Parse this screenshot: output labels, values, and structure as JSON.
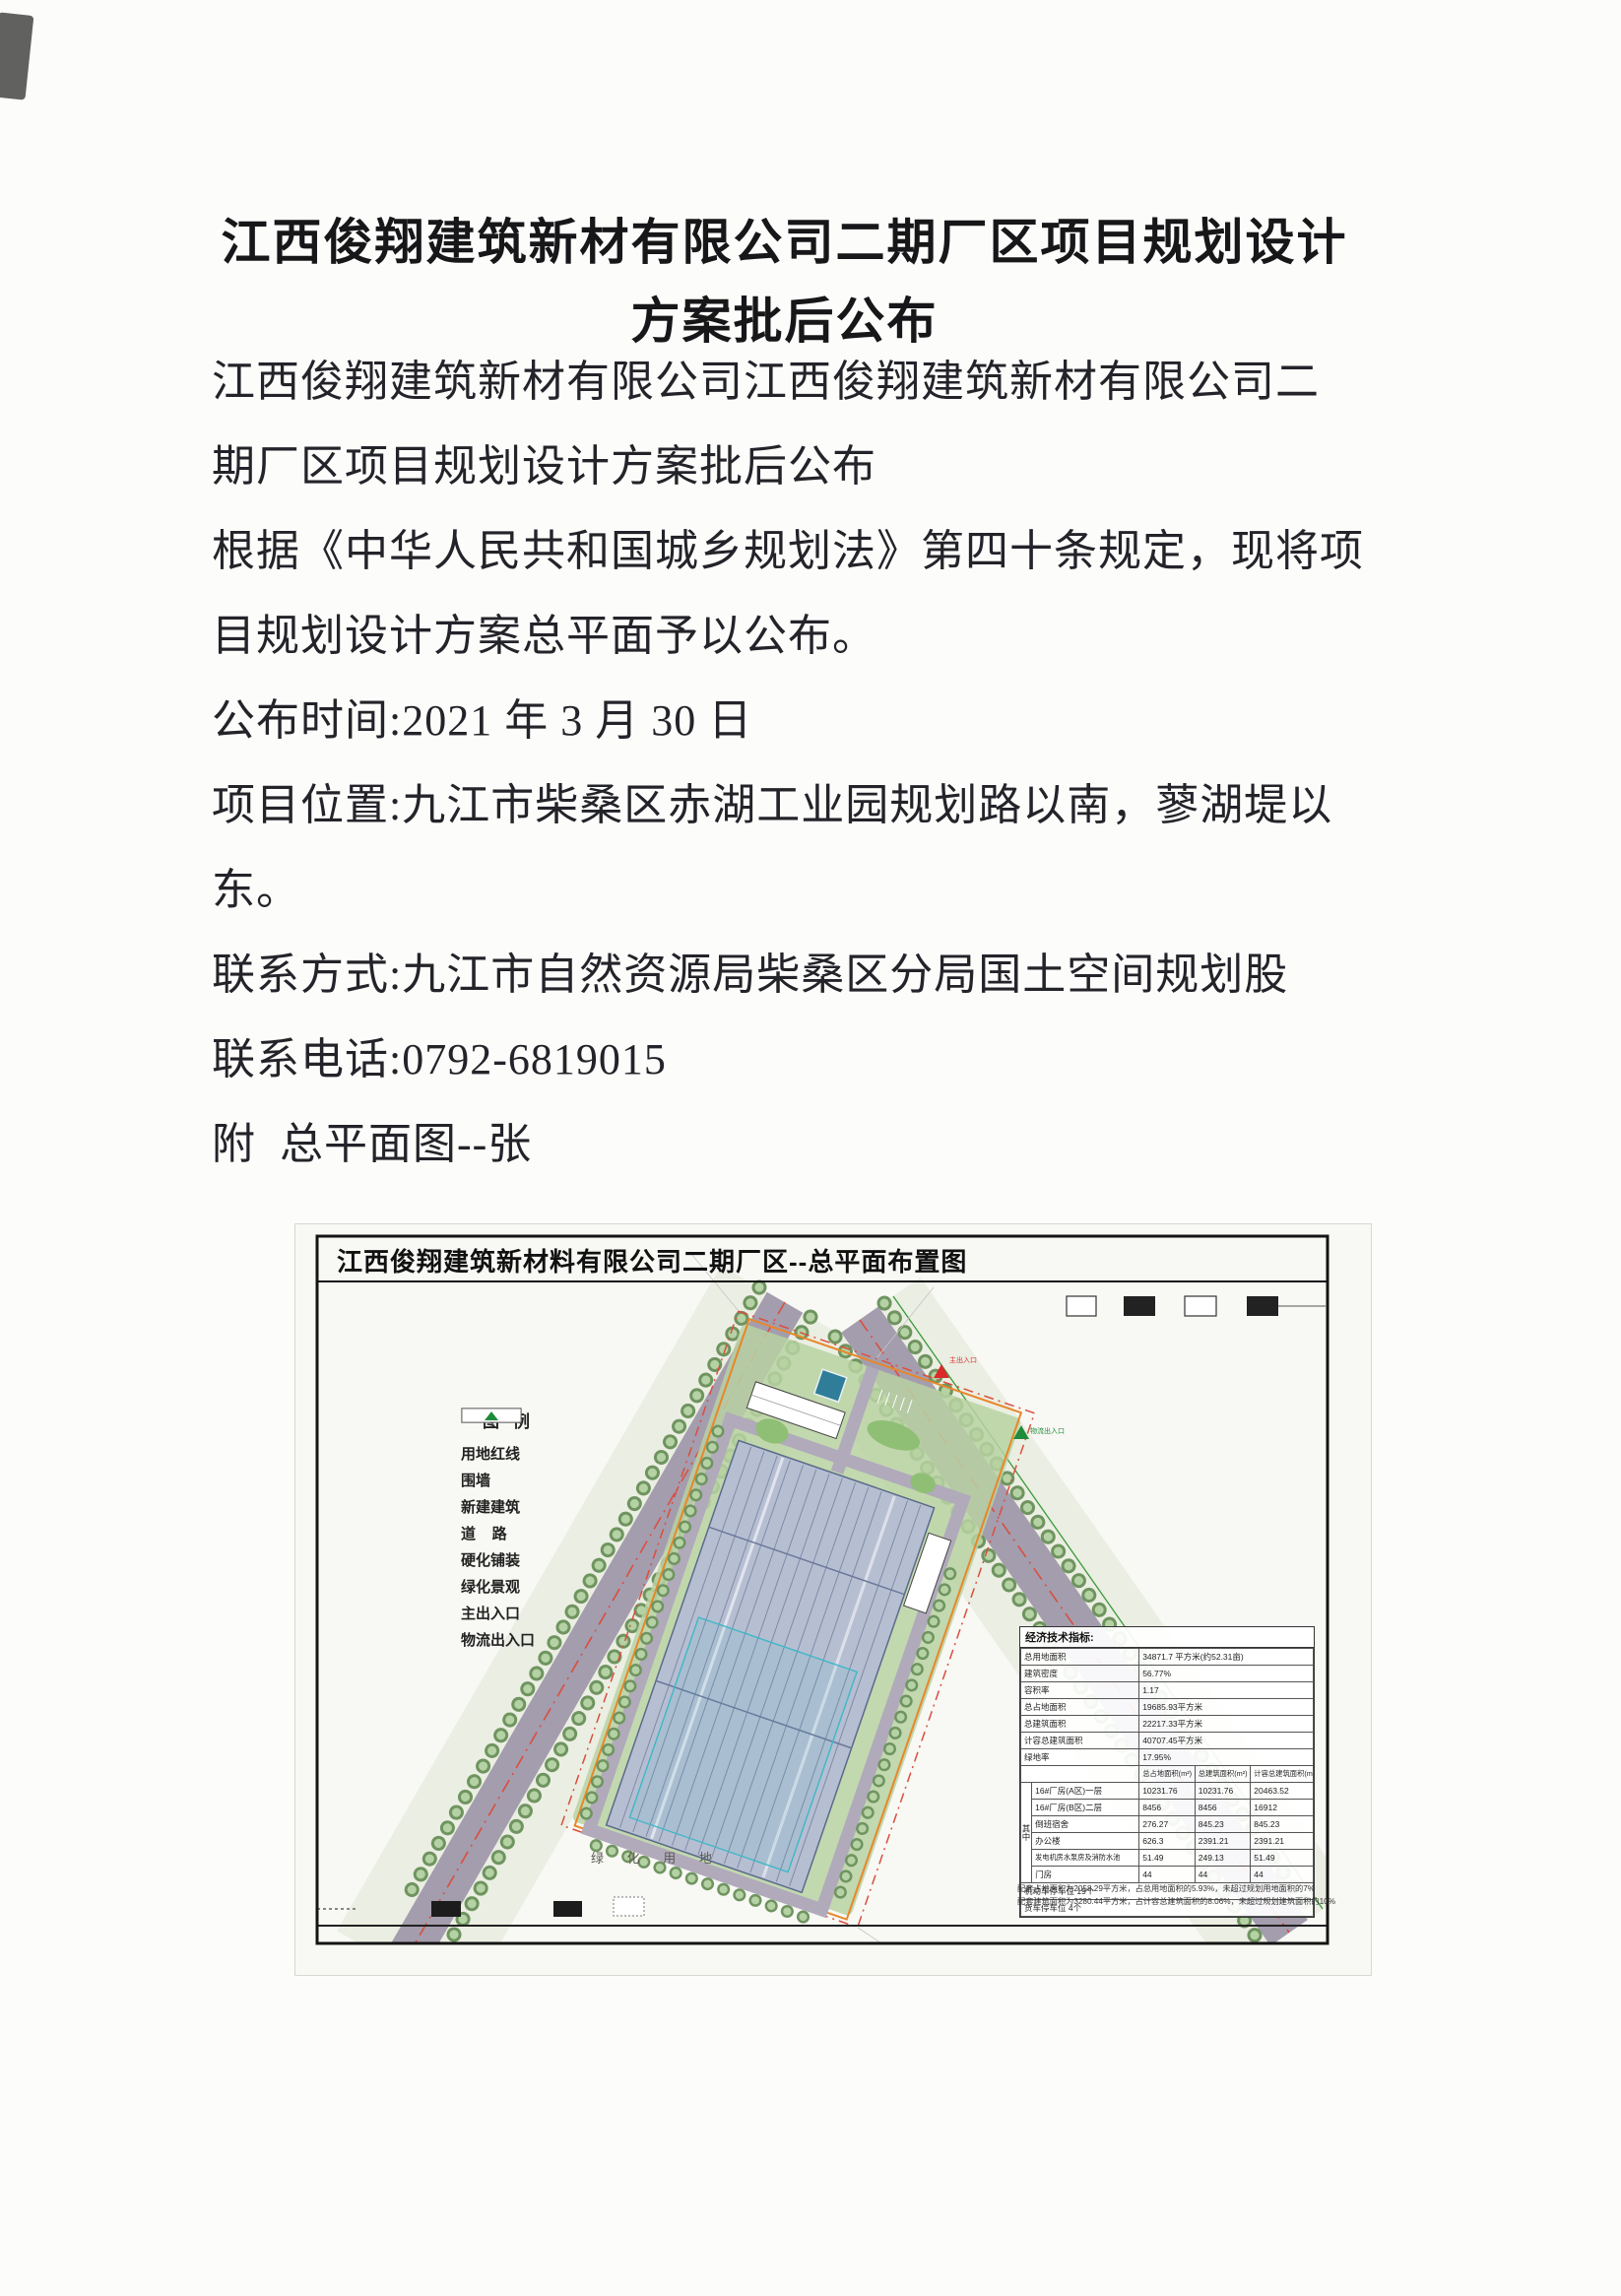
{
  "document": {
    "title_line1": "江西俊翔建筑新材有限公司二期厂区项目规划设计",
    "title_line2": "方案批后公布",
    "paragraphs": [
      "江西俊翔建筑新材有限公司江西俊翔建筑新材有限公司二",
      "期厂区项目规划设计方案批后公布",
      "根据《中华人民共和国城乡规划法》第四十条规定，现将项",
      "目规划设计方案总平面予以公布。",
      "公布时间:2021 年 3 月 30 日",
      "项目位置:九江市柴桑区赤湖工业园规划路以南，蓼湖堤以",
      "东。",
      "联系方式:九江市自然资源局柴桑区分局国土空间规划股",
      "联系电话:0792-6819015",
      "附  总平面图--张"
    ]
  },
  "plan": {
    "title": "江西俊翔建筑新材料有限公司二期厂区--总平面布置图",
    "legend": {
      "title": "图例",
      "items": [
        {
          "label": "用地红线"
        },
        {
          "label": "围墙"
        },
        {
          "label": "新建建筑"
        },
        {
          "label": "道    路"
        },
        {
          "label": "硬化铺装"
        },
        {
          "label": "绿化景观"
        },
        {
          "label": "主出入口"
        },
        {
          "label": "物流出入口"
        }
      ]
    },
    "indicators": {
      "title": "经济技术指标:",
      "rows": [
        {
          "label": "总用地面积",
          "value": "34871.7 平方米(约52.31亩)"
        },
        {
          "label": "建筑密度",
          "value": "56.77%"
        },
        {
          "label": "容积率",
          "value": "1.17"
        },
        {
          "label": "总占地面积",
          "value": "19685.93平方米"
        },
        {
          "label": "总建筑面积",
          "value": "22217.33平方米"
        },
        {
          "label": "计容总建筑面积",
          "value": "40707.45平方米"
        },
        {
          "label": "绿地率",
          "value": "17.95%"
        }
      ],
      "sub_table": {
        "group_label": "其中",
        "headers": [
          "总占地面积(m²)",
          "总建筑面积(m²)",
          "计容总建筑面积(m²)"
        ],
        "rows": [
          {
            "label": "16#厂房(A区)一层",
            "v1": "10231.76",
            "v2": "10231.76",
            "v3": "20463.52"
          },
          {
            "label": "16#厂房(B区)二层",
            "v1": "8456",
            "v2": "8456",
            "v3": "16912"
          },
          {
            "label": "倒班宿舍",
            "v1": "276.27",
            "v2": "845.23",
            "v3": "845.23"
          },
          {
            "label": "办公楼",
            "v1": "626.3",
            "v2": "2391.21",
            "v3": "2391.21"
          },
          {
            "label": "发电机房水泵房及消防水池",
            "v1": "51.49",
            "v2": "249.13",
            "v3": "51.49"
          },
          {
            "label": "门房",
            "v1": "44",
            "v2": "44",
            "v3": "44"
          }
        ]
      },
      "parking": [
        "机动车停车位 19个",
        "货车停车位 4个"
      ],
      "notes": [
        "配套占地面积为2058.29平方米，占总用地面积的5.93%，未超过规划用地面积的7%",
        "配套建筑面积为3280.44平方米，占计容总建筑面积的8.06%，未超过规划建筑面积的10%"
      ]
    },
    "labels": {
      "green_area": "绿 化 用 地",
      "main_entrance": "主出入口",
      "logistics_entrance": "物流出入口"
    },
    "colors": {
      "boundary_red": "#d94f3f",
      "parcel_orange": "#e8872a",
      "road_gray": "#a49dae",
      "tree_green": "#6f9460",
      "factory_blue": "#b6bfd2",
      "teal_accent": "#3fb7c7"
    }
  }
}
